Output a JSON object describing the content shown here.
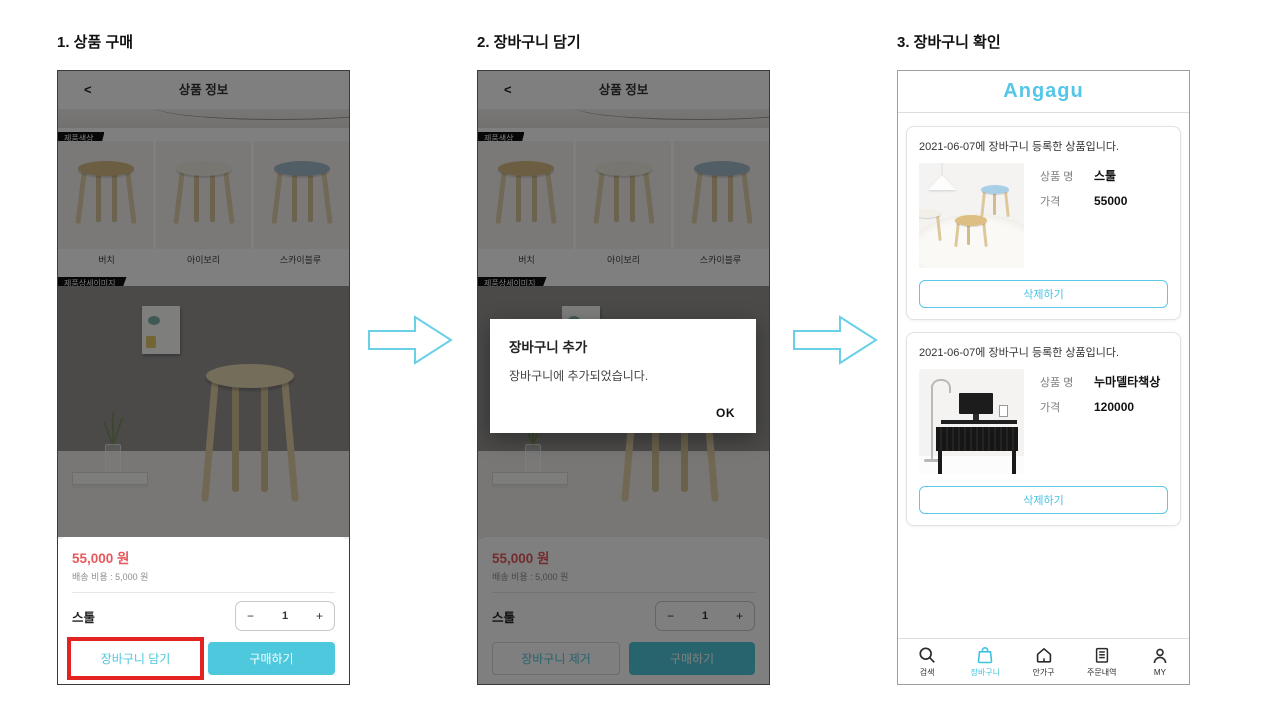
{
  "steps": {
    "step1": "1. 상품 구매",
    "step2": "2. 장바구니 담기",
    "step3": "3. 장바구니 확인"
  },
  "colors": {
    "accent_cyan": "#4ec8dc",
    "logo_cyan": "#55c6e8",
    "price_red": "#e8575a",
    "annotation_red": "#e32222",
    "nav_active_cyan": "#3ec3de"
  },
  "screen1": {
    "header": {
      "back": "<",
      "title": "상품 정보"
    },
    "tag_color": "제품색상",
    "tag_detail": "제품상세이미지",
    "color_options": [
      {
        "label": "버치"
      },
      {
        "label": "아이보리"
      },
      {
        "label": "스카이블루"
      }
    ],
    "sheet": {
      "price": "55,000 원",
      "shipping": "배송 비용 : 5,000 원",
      "product_name": "스툴",
      "minus": "−",
      "qty": "1",
      "plus": "+",
      "cart_button": "장바구니 담기",
      "buy_button": "구매하기"
    }
  },
  "screen2": {
    "header": {
      "back": "<",
      "title": "상품 정보"
    },
    "tag_color": "제품색상",
    "tag_detail": "제품상세이미지",
    "color_options": [
      {
        "label": "버치"
      },
      {
        "label": "아이보리"
      },
      {
        "label": "스카이블루"
      }
    ],
    "dialog": {
      "title": "장바구니 추가",
      "message": "장바구니에 추가되었습니다.",
      "ok": "OK"
    },
    "sheet": {
      "price": "55,000 원",
      "shipping": "배송 비용 : 5,000 원",
      "product_name": "스툴",
      "minus": "−",
      "qty": "1",
      "plus": "+",
      "cart_button": "장바구니 제거",
      "buy_button": "구매하기"
    }
  },
  "screen3": {
    "logo": "Angagu",
    "items": [
      {
        "date": "2021-06-07에 장바구니 등록한 상품입니다.",
        "name_label": "상품 명",
        "name": "스툴",
        "price_label": "가격",
        "price": "55000",
        "delete_label": "삭제하기"
      },
      {
        "date": "2021-06-07에 장바구니 등록한 상품입니다.",
        "name_label": "상품 명",
        "name": "누마델타책상",
        "price_label": "가격",
        "price": "120000",
        "delete_label": "삭제하기"
      }
    ],
    "nav": [
      {
        "label": "검색",
        "icon": "search-icon"
      },
      {
        "label": "장바구니",
        "icon": "bag-icon",
        "active": true
      },
      {
        "label": "안가구",
        "icon": "home-icon"
      },
      {
        "label": "주문내역",
        "icon": "orders-icon"
      },
      {
        "label": "MY",
        "icon": "person-icon"
      }
    ]
  }
}
